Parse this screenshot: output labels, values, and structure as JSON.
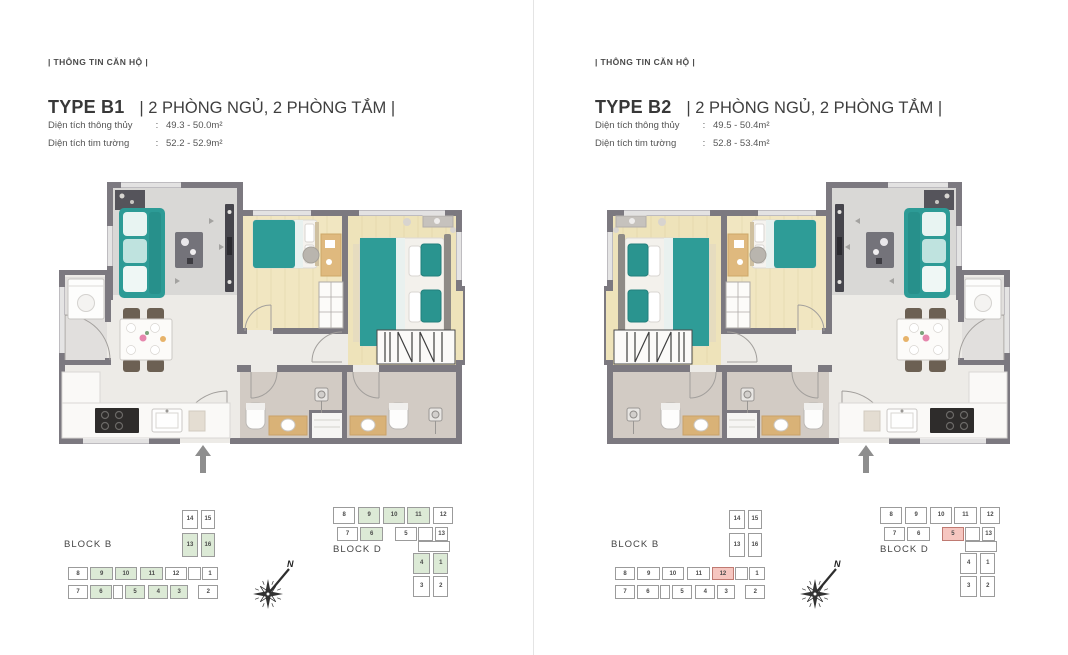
{
  "page": {
    "background": "#ffffff",
    "divider_color": "#e4e4e4"
  },
  "panels": [
    {
      "info_label": "| THÔNG TIN CĂN HỘ |",
      "type_label": "TYPE B1",
      "rooms_label": "| 2 PHÒNG NGỦ, 2 PHÒNG TẮM |",
      "specs": [
        {
          "label": "Diện tích thông thủy",
          "colon": ":",
          "value": "49.3 - 50.0m²"
        },
        {
          "label": "Diện tích tim tường",
          "colon": ":",
          "value": "52.2 - 52.9m²"
        }
      ],
      "highlight_fill": "#dcead6",
      "highlight_border": "#9b9b9b",
      "compass_label": "N",
      "blocks": [
        {
          "name": "BLOCK B",
          "units": [
            {
              "n": "14",
              "x": 74.8,
              "y": 4,
              "w": 10.4,
              "h": 19
            },
            {
              "n": "15",
              "x": 86.7,
              "y": 4,
              "w": 8.9,
              "h": 19
            },
            {
              "n": "13",
              "x": 74.8,
              "y": 28,
              "w": 10.4,
              "h": 24,
              "hl": true
            },
            {
              "n": "16",
              "x": 86.7,
              "y": 28,
              "w": 8.9,
              "h": 24,
              "hl": true
            },
            {
              "n": "8",
              "x": 3.6,
              "y": 62,
              "w": 12.9,
              "h": 14
            },
            {
              "n": "9",
              "x": 17.5,
              "y": 62,
              "w": 14.6,
              "h": 14,
              "hl": true
            },
            {
              "n": "10",
              "x": 33.1,
              "y": 62,
              "w": 13.6,
              "h": 14,
              "hl": true
            },
            {
              "n": "11",
              "x": 48.8,
              "y": 62,
              "w": 14.6,
              "h": 14,
              "hl": true
            },
            {
              "n": "12",
              "x": 64.4,
              "y": 62,
              "w": 13.6,
              "h": 14
            },
            {
              "n": "",
              "x": 78.9,
              "y": 62,
              "w": 8,
              "h": 14
            },
            {
              "n": "1",
              "x": 87.3,
              "y": 62,
              "w": 10.4,
              "h": 14
            },
            {
              "n": "7",
              "x": 3.6,
              "y": 81,
              "w": 12.9,
              "h": 14
            },
            {
              "n": "6",
              "x": 17.5,
              "y": 81,
              "w": 13.6,
              "h": 14,
              "hl": true
            },
            {
              "n": "",
              "x": 32.1,
              "y": 81,
              "w": 6.3,
              "h": 14
            },
            {
              "n": "5",
              "x": 39.4,
              "y": 81,
              "w": 12.5,
              "h": 14,
              "hl": true
            },
            {
              "n": "4",
              "x": 53.9,
              "y": 81,
              "w": 12.5,
              "h": 14,
              "hl": true
            },
            {
              "n": "3",
              "x": 67.5,
              "y": 81,
              "w": 11.4,
              "h": 14,
              "hl": true
            },
            {
              "n": "2",
              "x": 85.2,
              "y": 81,
              "w": 12.5,
              "h": 14
            }
          ]
        },
        {
          "name": "BLOCK D",
          "units": [
            {
              "n": "8",
              "x": 2.6,
              "y": 3,
              "w": 17.4,
              "h": 17
            },
            {
              "n": "9",
              "x": 22.6,
              "y": 3,
              "w": 17.4,
              "h": 17,
              "hl": true
            },
            {
              "n": "10",
              "x": 42.6,
              "y": 3,
              "w": 17.4,
              "h": 17,
              "hl": true
            },
            {
              "n": "11",
              "x": 61.4,
              "y": 3,
              "w": 18.6,
              "h": 17,
              "hl": true
            },
            {
              "n": "12",
              "x": 82.6,
              "y": 3,
              "w": 16,
              "h": 17
            },
            {
              "n": "7",
              "x": 5.4,
              "y": 23,
              "w": 17.3,
              "h": 15
            },
            {
              "n": "6",
              "x": 24,
              "y": 23,
              "w": 18.6,
              "h": 15,
              "hl": true
            },
            {
              "n": "5",
              "x": 52,
              "y": 23,
              "w": 17.4,
              "h": 15
            },
            {
              "n": "",
              "x": 70.6,
              "y": 23,
              "w": 12,
              "h": 15
            },
            {
              "n": "13",
              "x": 84,
              "y": 23,
              "w": 10.6,
              "h": 15
            },
            {
              "n": "",
              "x": 70.6,
              "y": 38,
              "w": 25,
              "h": 11
            },
            {
              "n": "4",
              "x": 66.6,
              "y": 50,
              "w": 13.4,
              "h": 21,
              "hl": true
            },
            {
              "n": "1",
              "x": 82.6,
              "y": 50,
              "w": 12,
              "h": 21,
              "hl": true
            },
            {
              "n": "3",
              "x": 66.6,
              "y": 73,
              "w": 13.4,
              "h": 22
            },
            {
              "n": "2",
              "x": 82.6,
              "y": 73,
              "w": 12,
              "h": 22
            }
          ]
        }
      ]
    },
    {
      "info_label": "| THÔNG TIN CĂN HỘ |",
      "type_label": "TYPE B2",
      "rooms_label": "| 2 PHÒNG NGỦ, 2 PHÒNG TẮM |",
      "specs": [
        {
          "label": "Diện tích thông thủy",
          "colon": ":",
          "value": "49.5 - 50.4m²"
        },
        {
          "label": "Diện tích tim tường",
          "colon": ":",
          "value": "52.8 - 53.4m²"
        }
      ],
      "highlight_fill": "#f6c6c0",
      "highlight_border": "#bf7a72",
      "compass_label": "N",
      "blocks": [
        {
          "name": "BLOCK B",
          "units": [
            {
              "n": "14",
              "x": 74.8,
              "y": 4,
              "w": 10.4,
              "h": 19
            },
            {
              "n": "15",
              "x": 86.7,
              "y": 4,
              "w": 8.9,
              "h": 19
            },
            {
              "n": "13",
              "x": 74.8,
              "y": 28,
              "w": 10.4,
              "h": 24
            },
            {
              "n": "16",
              "x": 86.7,
              "y": 28,
              "w": 8.9,
              "h": 24
            },
            {
              "n": "8",
              "x": 3.6,
              "y": 62,
              "w": 12.9,
              "h": 14
            },
            {
              "n": "9",
              "x": 17.5,
              "y": 62,
              "w": 14.6,
              "h": 14
            },
            {
              "n": "10",
              "x": 33.1,
              "y": 62,
              "w": 13.6,
              "h": 14
            },
            {
              "n": "11",
              "x": 48.8,
              "y": 62,
              "w": 14.6,
              "h": 14
            },
            {
              "n": "12",
              "x": 64.4,
              "y": 62,
              "w": 13.6,
              "h": 14,
              "hl": true
            },
            {
              "n": "",
              "x": 78.9,
              "y": 62,
              "w": 8,
              "h": 14
            },
            {
              "n": "1",
              "x": 87.3,
              "y": 62,
              "w": 10.4,
              "h": 14
            },
            {
              "n": "7",
              "x": 3.6,
              "y": 81,
              "w": 12.9,
              "h": 14
            },
            {
              "n": "6",
              "x": 17.5,
              "y": 81,
              "w": 13.6,
              "h": 14
            },
            {
              "n": "",
              "x": 32.1,
              "y": 81,
              "w": 6.3,
              "h": 14
            },
            {
              "n": "5",
              "x": 39.4,
              "y": 81,
              "w": 12.5,
              "h": 14
            },
            {
              "n": "4",
              "x": 53.9,
              "y": 81,
              "w": 12.5,
              "h": 14
            },
            {
              "n": "3",
              "x": 67.5,
              "y": 81,
              "w": 11.4,
              "h": 14
            },
            {
              "n": "2",
              "x": 85.2,
              "y": 81,
              "w": 12.5,
              "h": 14
            }
          ]
        },
        {
          "name": "BLOCK D",
          "units": [
            {
              "n": "8",
              "x": 2.6,
              "y": 3,
              "w": 17.4,
              "h": 17
            },
            {
              "n": "9",
              "x": 22.6,
              "y": 3,
              "w": 17.4,
              "h": 17
            },
            {
              "n": "10",
              "x": 42.6,
              "y": 3,
              "w": 17.4,
              "h": 17
            },
            {
              "n": "11",
              "x": 61.4,
              "y": 3,
              "w": 18.6,
              "h": 17
            },
            {
              "n": "12",
              "x": 82.6,
              "y": 3,
              "w": 16,
              "h": 17
            },
            {
              "n": "7",
              "x": 5.4,
              "y": 23,
              "w": 17.3,
              "h": 15
            },
            {
              "n": "6",
              "x": 24,
              "y": 23,
              "w": 18.6,
              "h": 15
            },
            {
              "n": "5",
              "x": 52,
              "y": 23,
              "w": 17.4,
              "h": 15,
              "hl": true
            },
            {
              "n": "",
              "x": 70.6,
              "y": 23,
              "w": 12,
              "h": 15
            },
            {
              "n": "13",
              "x": 84,
              "y": 23,
              "w": 10.6,
              "h": 15
            },
            {
              "n": "",
              "x": 70.6,
              "y": 38,
              "w": 25,
              "h": 11
            },
            {
              "n": "4",
              "x": 66.6,
              "y": 50,
              "w": 13.4,
              "h": 21
            },
            {
              "n": "1",
              "x": 82.6,
              "y": 50,
              "w": 12,
              "h": 21
            },
            {
              "n": "3",
              "x": 66.6,
              "y": 73,
              "w": 13.4,
              "h": 22
            },
            {
              "n": "2",
              "x": 82.6,
              "y": 73,
              "w": 12,
              "h": 22
            }
          ]
        }
      ]
    }
  ]
}
